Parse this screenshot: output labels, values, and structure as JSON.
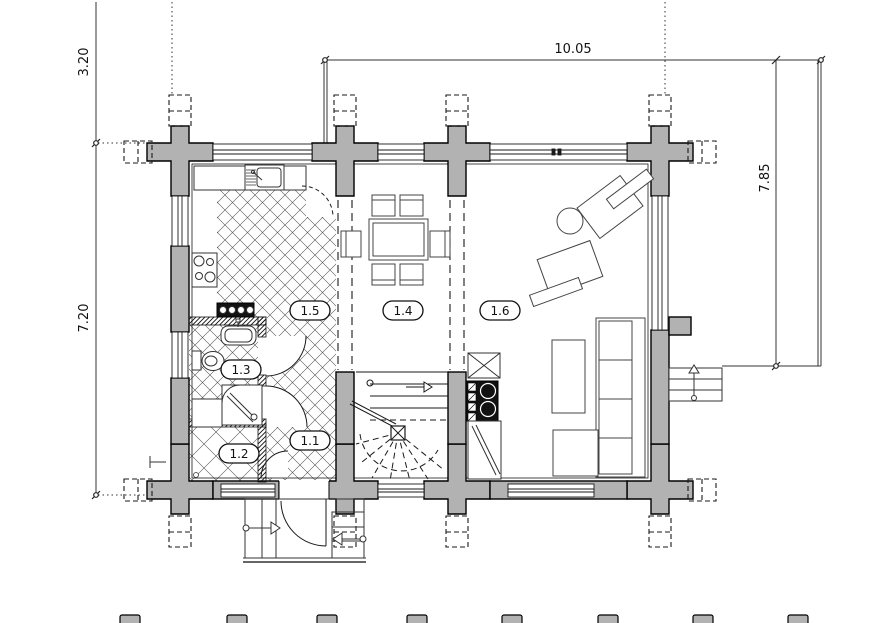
{
  "title": "floor-plan",
  "colors": {
    "wall_fill": "#b2b2b2",
    "line": "#1a1a1a",
    "stove_fill": "#111111"
  },
  "dimensions": {
    "left_upper": {
      "value": "3.20"
    },
    "left_lower": {
      "value": "7.20"
    },
    "top": {
      "value": "10.05"
    },
    "right": {
      "value": "7.85"
    }
  },
  "rooms": [
    {
      "label": "1.1"
    },
    {
      "label": "1.2"
    },
    {
      "label": "1.3"
    },
    {
      "label": "1.4"
    },
    {
      "label": "1.5"
    },
    {
      "label": "1.6"
    }
  ],
  "symbols": {
    "stair_direction": "up-arrow",
    "entry_arrows": "entry-direction-arrows",
    "floor_hatch": "ceramic-tile-crosshatch",
    "wall_crosses": "log-wall-corner-joints"
  }
}
